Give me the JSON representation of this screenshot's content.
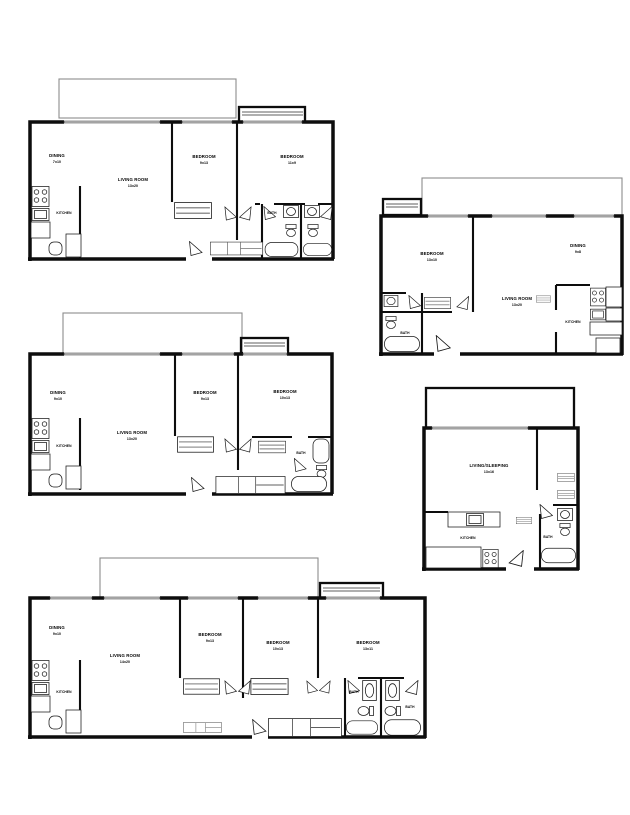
{
  "plans": [
    {
      "name": "two-bedroom-two-bath",
      "rooms": {
        "dining": {
          "label": "DINING",
          "dims": "7x10"
        },
        "living": {
          "label": "LIVING ROOM",
          "dims": "13x20"
        },
        "bedroom1": {
          "label": "BEDROOM",
          "dims": "9x13"
        },
        "bedroom2": {
          "label": "BEDROOM",
          "dims": "11x9"
        },
        "kitchen": {
          "label": "KITCHEN"
        },
        "bath": {
          "label": "BATH"
        }
      }
    },
    {
      "name": "one-bedroom",
      "rooms": {
        "bedroom": {
          "label": "BEDROOM",
          "dims": "13x10"
        },
        "dining": {
          "label": "DINING",
          "dims": "9x8"
        },
        "living": {
          "label": "LIVING ROOM",
          "dims": "13x20"
        },
        "kitchen": {
          "label": "KITCHEN"
        },
        "bath": {
          "label": "BATH"
        }
      }
    },
    {
      "name": "two-bedroom",
      "rooms": {
        "dining": {
          "label": "DINING",
          "dims": "9x10"
        },
        "living": {
          "label": "LIVING ROOM",
          "dims": "13x20"
        },
        "bedroom1": {
          "label": "BEDROOM",
          "dims": "9x13"
        },
        "bedroom2": {
          "label": "BEDROOM",
          "dims": "10x13"
        },
        "kitchen": {
          "label": "KITCHEN"
        },
        "bath": {
          "label": "BATH"
        }
      }
    },
    {
      "name": "studio",
      "rooms": {
        "living": {
          "label": "LIVING/SLEEPING",
          "dims": "13x16"
        },
        "kitchen": {
          "label": "KITCHEN"
        },
        "bath": {
          "label": "BATH"
        }
      }
    },
    {
      "name": "three-bedroom",
      "rooms": {
        "dining": {
          "label": "DINING",
          "dims": "9x10"
        },
        "living": {
          "label": "LIVING ROOM",
          "dims": "14x20"
        },
        "bedroom1": {
          "label": "BEDROOM",
          "dims": "9x13"
        },
        "bedroom2": {
          "label": "BEDROOM",
          "dims": "10x13"
        },
        "bedroom3": {
          "label": "BEDROOM",
          "dims": "13x11"
        },
        "kitchen": {
          "label": "KITCHEN"
        },
        "bath1": {
          "label": "BATH"
        },
        "bath2": {
          "label": "BATH"
        }
      }
    }
  ]
}
